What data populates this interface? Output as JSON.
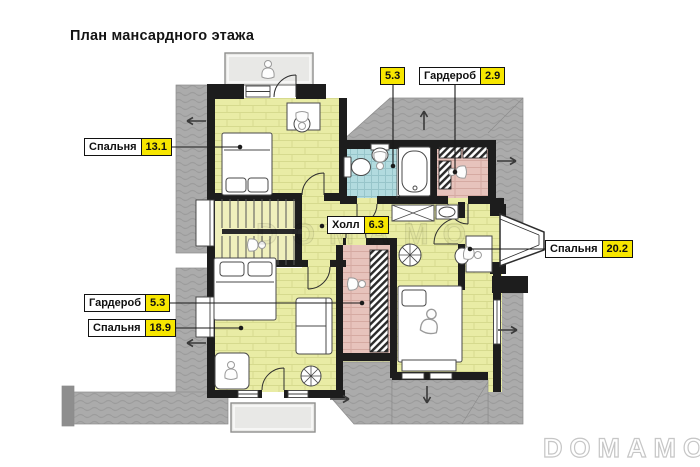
{
  "page": {
    "title": "План мансардного этажа"
  },
  "watermark": {
    "brand_center": "DOMAMO",
    "brand_corner": "DOMAMO"
  },
  "room_labels": [
    {
      "name": "Спальня",
      "area": "13.1"
    },
    {
      "name": "",
      "area": "5.3"
    },
    {
      "name": "Гардероб",
      "area": "2.9"
    },
    {
      "name": "Холл",
      "area": "6.3"
    },
    {
      "name": "Спальня",
      "area": "20.2"
    },
    {
      "name": "Гардероб",
      "area": "5.3"
    },
    {
      "name": "Спальня",
      "area": "18.9"
    }
  ],
  "roof_arrows": [
    "left",
    "left",
    "up",
    "right",
    "right",
    "right",
    "down"
  ],
  "colors": {
    "label_area_yellow": "#f7e600",
    "floor_wood_yellow": "#e9eca5",
    "floor_tile_blue": "#b2dbdf",
    "floor_pink": "#e7c3bc",
    "roof_gray": "#ababab",
    "wall_dark": "#1d1d1d",
    "balcony_gray": "#e8e8e6",
    "watermark_gray": "#c6c6c6"
  }
}
